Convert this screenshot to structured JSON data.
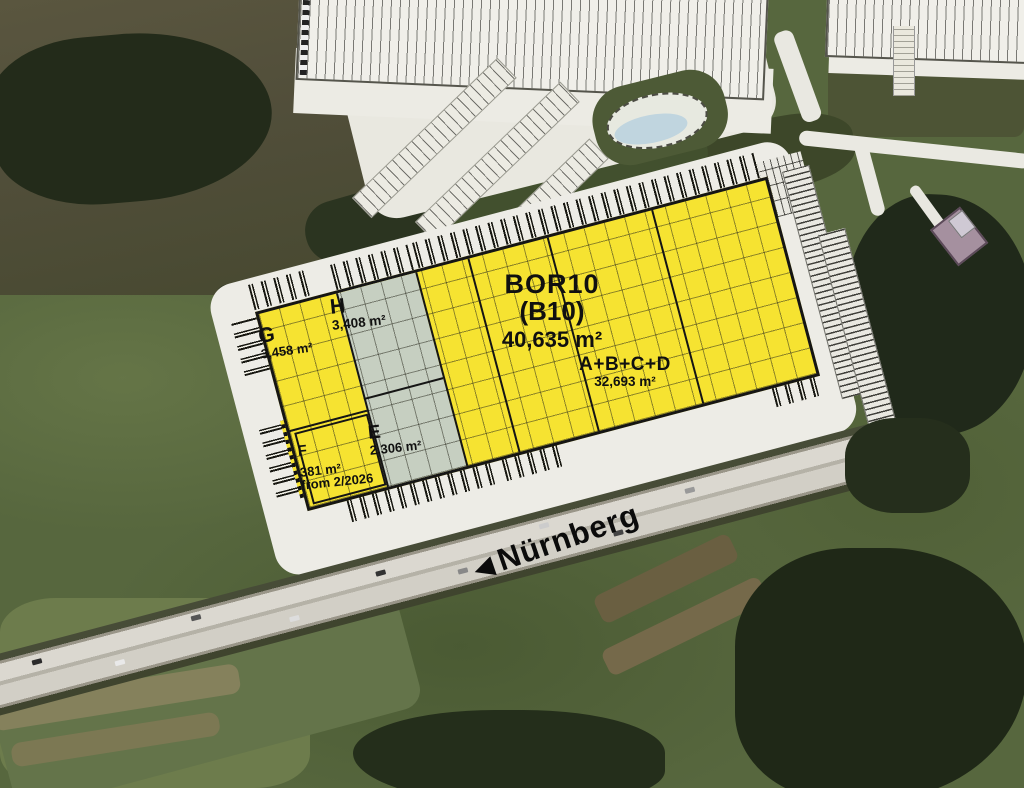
{
  "site_plan": {
    "main_building": {
      "code": "BOR10",
      "code_alt": "(B10)",
      "total_area": "40,635 m²"
    },
    "units": [
      {
        "id": "A+B+C+D",
        "area": "32,693 m²"
      },
      {
        "id": "E",
        "area": "2,306 m²"
      },
      {
        "id": "F",
        "area": "381 m²",
        "note": "from 2/2026"
      },
      {
        "id": "G",
        "area": "3,458 m²"
      },
      {
        "id": "H",
        "area": "3,408 m²"
      }
    ],
    "direction": {
      "arrow": "◀",
      "label": "Nürnberg"
    },
    "colors": {
      "highlighted_unit": "#f6e331",
      "secondary_unit": "#c6cfc1",
      "plan_surface": "#edece6",
      "building_outline": "#151515",
      "landmark_building": "#a5909f",
      "pond_water": "#c0d5df"
    }
  }
}
